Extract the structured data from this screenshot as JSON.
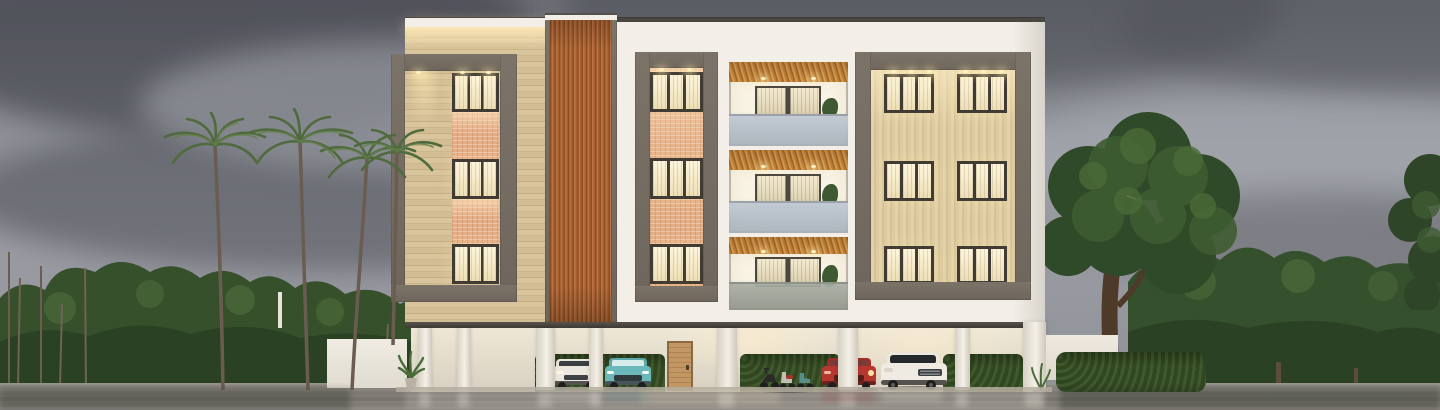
{
  "meta": {
    "type": "architectural-exterior-render",
    "sky_condition": "stormy overcast clouds",
    "surface": "wet reflective pavement"
  },
  "palette": {
    "sky_top": "#6e7078",
    "sky_mid": "#8f9198",
    "sky_low": "#9b9ca3",
    "cloud_dark": "#5c5e66",
    "cloud_light": "#b0b1b8",
    "facade_white": "#f3efe8",
    "facade_shadow": "#e0dbd1",
    "roof_dark": "#3d3b37",
    "stone_light": "#d5bf99",
    "stone_dark": "#c6ad80",
    "brick": "#e5ad85",
    "wood": "#b5703f",
    "wood_dark": "#8d5023",
    "concrete": "#756c62",
    "concrete_dark": "#686057",
    "window_glow": "#fdf4da",
    "window_mullion": "#403b33",
    "light_warm": "#ffe9b8",
    "balcony_inner": "#f9f3e5",
    "balcony_ceiling": "#c08036",
    "railing_glass": "#c2cbd4",
    "hedge": "#3c5430",
    "leaf_dark": "#2e4527",
    "leaf_mid": "#3f5a33",
    "leaf_light": "#5d7a4a",
    "palm_leaf": "#4f6b3e",
    "trunk": "#6b5e50",
    "big_trunk": "#4e3a28",
    "ground": "#87837c",
    "ground_dark": "#6e6b66",
    "kerb": "#b3ac9e",
    "wall_white": "#e9e4da",
    "parking_wall": "#e2dac9",
    "door_wood": "#b9905f",
    "car_white": "#ece8df",
    "car_teal": "#6ab8b9",
    "car_red": "#b5372e"
  },
  "scene": {
    "vegetation": {
      "palm_trees": 4,
      "left_treeline": "dense green scrub with bare saplings",
      "right_large_tree": "broad canopy over compound wall",
      "right_treeline": "continuous green band to horizon"
    },
    "building": {
      "storeys": 3,
      "ground_level": "open stilt parking",
      "materials": [
        "white plaster",
        "beige travertine",
        "terracotta brick",
        "vertical wood slats",
        "grey concrete frames"
      ],
      "lit_window_columns": 3,
      "right_window_grid": "2 columns x 3 rows",
      "balconies": 3,
      "balcony_features": [
        "wood slat ceiling",
        "downlights",
        "glass sliding door",
        "frosted glass railing",
        "potted plant"
      ]
    },
    "parking": {
      "columns": 8,
      "entrance_door": "single wood door",
      "hedges": "green hedge behind vehicles",
      "vehicles": [
        {
          "type": "suv",
          "color_name": "white",
          "view": "front"
        },
        {
          "type": "suv",
          "color_name": "teal",
          "view": "front"
        },
        {
          "type": "motorcycle",
          "color_name": "black"
        },
        {
          "type": "scooter",
          "color_name": "red-white"
        },
        {
          "type": "scooter",
          "color_name": "teal"
        },
        {
          "type": "suv",
          "color_name": "red",
          "view": "front"
        },
        {
          "type": "suv",
          "color_name": "white",
          "view": "front-three-quarter"
        }
      ],
      "small_plants": 2
    },
    "side_walls": [
      "low white compound wall left",
      "low white compound wall right"
    ]
  }
}
